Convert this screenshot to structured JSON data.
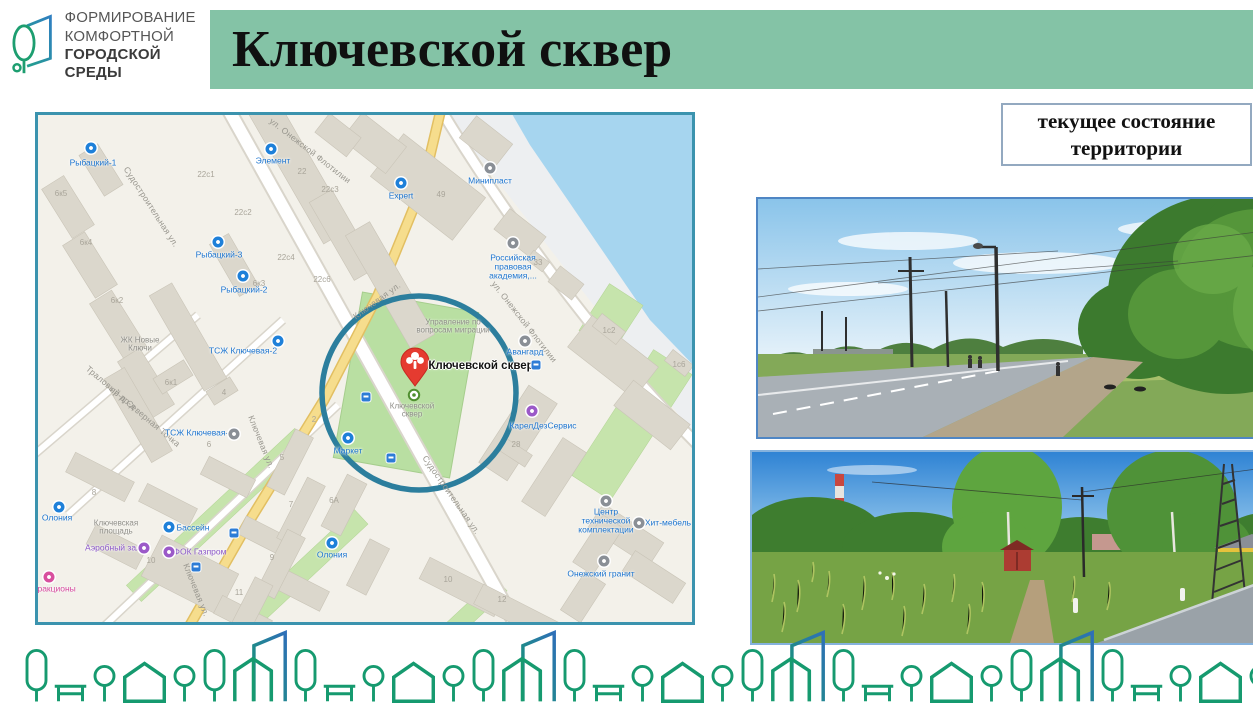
{
  "header": {
    "logo": {
      "lines": [
        "ФОРМИРОВАНИЕ",
        "КОМФОРТНОЙ",
        "ГОРОДСКОЙ СРЕДЫ"
      ]
    },
    "title": "Ключевской сквер",
    "banner_color": "#84c3a6"
  },
  "status_box": {
    "text": "текущее состояние территории",
    "border_color": "#93a9c0"
  },
  "map": {
    "border_color": "#3b93ae",
    "highlight": {
      "shape": "circle",
      "color": "#2c7e9d"
    },
    "pin": {
      "label": "Ключевской сквер",
      "color": "#e53b30"
    },
    "marker_caption": "Ключевской сквер",
    "labels": [
      {
        "t": "Судостроительная ул.",
        "x": 113,
        "y": 92,
        "cls": "street",
        "r": 57
      },
      {
        "t": "ул. Онежской Флотилии",
        "x": 272,
        "y": 36,
        "cls": "street",
        "r": 38
      },
      {
        "t": "ул. Онежской Флотилии",
        "x": 486,
        "y": 207,
        "cls": "street",
        "r": 52
      },
      {
        "t": "Ключевая ул.",
        "x": 339,
        "y": 186,
        "cls": "street",
        "r": -36
      },
      {
        "t": "Ключевая ул.",
        "x": 223,
        "y": 327,
        "cls": "street",
        "r": 68
      },
      {
        "t": "Ключевая ул.",
        "x": 158,
        "y": 475,
        "cls": "street",
        "r": 68
      },
      {
        "t": "Судостроительная ул.",
        "x": 413,
        "y": 380,
        "cls": "street",
        "r": 55
      },
      {
        "t": "Траловый пр-д",
        "x": 73,
        "y": 273,
        "cls": "street",
        "r": 40
      },
      {
        "t": "пр-д Северная Точка",
        "x": 107,
        "y": 302,
        "cls": "street",
        "r": 40
      },
      {
        "t": "Рыбацкий-1",
        "x": 55,
        "y": 48,
        "cls": "poi"
      },
      {
        "t": "Элемент",
        "x": 235,
        "y": 46,
        "cls": "poi"
      },
      {
        "t": "Expert",
        "x": 363,
        "y": 81,
        "cls": "poi"
      },
      {
        "t": "Рыбацкий-3",
        "x": 181,
        "y": 140,
        "cls": "poi"
      },
      {
        "t": "Рыбацкий-2",
        "x": 206,
        "y": 175,
        "cls": "poi"
      },
      {
        "t": "Минипласт",
        "x": 452,
        "y": 66,
        "cls": "poi"
      },
      {
        "t": "Российская правовая академия,...",
        "x": 475,
        "y": 152,
        "cls": "poi",
        "w": 64
      },
      {
        "t": "Авангард",
        "x": 487,
        "y": 237,
        "cls": "poi"
      },
      {
        "t": "Управление по вопросам миграции",
        "x": 415,
        "y": 212,
        "cls": "gray",
        "w": 80
      },
      {
        "t": "КарелДезСервис",
        "x": 505,
        "y": 311,
        "cls": "poi"
      },
      {
        "t": "Маркет",
        "x": 310,
        "y": 336,
        "cls": "poi"
      },
      {
        "t": "ТСЖ Ключевая-2",
        "x": 205,
        "y": 236,
        "cls": "poi"
      },
      {
        "t": "ТСЖ Ключевая-6",
        "x": 161,
        "y": 318,
        "cls": "poi"
      },
      {
        "t": "ЖК Новые Ключи",
        "x": 102,
        "y": 230,
        "cls": "gray",
        "w": 56
      },
      {
        "t": "Ключевская площадь",
        "x": 78,
        "y": 413,
        "cls": "gray",
        "w": 70
      },
      {
        "t": "Бассейн",
        "x": 155,
        "y": 413,
        "cls": "poi"
      },
      {
        "t": "Аэробный зал",
        "x": 75,
        "y": 433,
        "cls": "purple"
      },
      {
        "t": "ФОК Газпром",
        "x": 162,
        "y": 437,
        "cls": "purple"
      },
      {
        "t": "Олония",
        "x": 19,
        "y": 403,
        "cls": "poi"
      },
      {
        "t": "Олония",
        "x": 294,
        "y": 440,
        "cls": "poi"
      },
      {
        "t": "Аттракционы",
        "x": 12,
        "y": 474,
        "cls": "pink"
      },
      {
        "t": "Центр технической комплектации",
        "x": 568,
        "y": 406,
        "cls": "poi",
        "w": 72
      },
      {
        "t": "Хит-мебель",
        "x": 630,
        "y": 408,
        "cls": "poi"
      },
      {
        "t": "Онежский гранит",
        "x": 563,
        "y": 459,
        "cls": "poi"
      },
      {
        "t": "Ключевской сквер",
        "x": 443,
        "y": 251,
        "cls": "title"
      },
      {
        "t": "Ключевской сквер",
        "x": 374,
        "y": 296,
        "cls": "gray",
        "w": 48
      },
      {
        "t": "6к5",
        "x": 23,
        "y": 79,
        "cls": "num"
      },
      {
        "t": "6к4",
        "x": 48,
        "y": 128,
        "cls": "num"
      },
      {
        "t": "6к2",
        "x": 79,
        "y": 186,
        "cls": "num"
      },
      {
        "t": "6к3",
        "x": 221,
        "y": 169,
        "cls": "num"
      },
      {
        "t": "22с1",
        "x": 168,
        "y": 60,
        "cls": "num"
      },
      {
        "t": "22с2",
        "x": 205,
        "y": 98,
        "cls": "num"
      },
      {
        "t": "22",
        "x": 264,
        "y": 57,
        "cls": "num"
      },
      {
        "t": "22с3",
        "x": 292,
        "y": 75,
        "cls": "num"
      },
      {
        "t": "22с4",
        "x": 248,
        "y": 143,
        "cls": "num"
      },
      {
        "t": "22с6",
        "x": 284,
        "y": 165,
        "cls": "num"
      },
      {
        "t": "49",
        "x": 403,
        "y": 80,
        "cls": "num"
      },
      {
        "t": "33",
        "x": 500,
        "y": 148,
        "cls": "num"
      },
      {
        "t": "1с2",
        "x": 571,
        "y": 216,
        "cls": "num"
      },
      {
        "t": "1с6",
        "x": 641,
        "y": 250,
        "cls": "num"
      },
      {
        "t": "6к1",
        "x": 133,
        "y": 268,
        "cls": "num"
      },
      {
        "t": "4",
        "x": 186,
        "y": 278,
        "cls": "num"
      },
      {
        "t": "6",
        "x": 171,
        "y": 330,
        "cls": "num"
      },
      {
        "t": "2",
        "x": 276,
        "y": 305,
        "cls": "num"
      },
      {
        "t": "5",
        "x": 244,
        "y": 343,
        "cls": "num"
      },
      {
        "t": "7",
        "x": 253,
        "y": 390,
        "cls": "num"
      },
      {
        "t": "6А",
        "x": 296,
        "y": 386,
        "cls": "num"
      },
      {
        "t": "9",
        "x": 234,
        "y": 443,
        "cls": "num"
      },
      {
        "t": "11",
        "x": 201,
        "y": 478,
        "cls": "num"
      },
      {
        "t": "8",
        "x": 56,
        "y": 378,
        "cls": "num"
      },
      {
        "t": "10",
        "x": 113,
        "y": 446,
        "cls": "num"
      },
      {
        "t": "28",
        "x": 478,
        "y": 330,
        "cls": "num"
      },
      {
        "t": "10",
        "x": 410,
        "y": 465,
        "cls": "num"
      },
      {
        "t": "12",
        "x": 464,
        "y": 485,
        "cls": "num"
      }
    ],
    "icons": [
      {
        "x": 53,
        "y": 33,
        "c": "#1e80d9"
      },
      {
        "x": 233,
        "y": 34,
        "c": "#1e80d9"
      },
      {
        "x": 363,
        "y": 68,
        "c": "#1e80d9"
      },
      {
        "x": 180,
        "y": 127,
        "c": "#1e80d9"
      },
      {
        "x": 205,
        "y": 161,
        "c": "#1e80d9"
      },
      {
        "x": 452,
        "y": 53,
        "c": "#8a8f96"
      },
      {
        "x": 475,
        "y": 128,
        "c": "#8a8f96"
      },
      {
        "x": 487,
        "y": 226,
        "c": "#8a8f96"
      },
      {
        "x": 494,
        "y": 296,
        "c": "#9b59c8"
      },
      {
        "x": 310,
        "y": 323,
        "c": "#1e80d9"
      },
      {
        "x": 240,
        "y": 226,
        "c": "#1e80d9"
      },
      {
        "x": 196,
        "y": 319,
        "c": "#8a8f96"
      },
      {
        "x": 131,
        "y": 412,
        "c": "#1e80d9"
      },
      {
        "x": 106,
        "y": 433,
        "c": "#9b59c8"
      },
      {
        "x": 131,
        "y": 437,
        "c": "#9b59c8"
      },
      {
        "x": 21,
        "y": 392,
        "c": "#1e80d9"
      },
      {
        "x": 294,
        "y": 428,
        "c": "#1e80d9"
      },
      {
        "x": 11,
        "y": 462,
        "c": "#d84f9e"
      },
      {
        "x": 568,
        "y": 386,
        "c": "#8a8f96"
      },
      {
        "x": 601,
        "y": 408,
        "c": "#8a8f96"
      },
      {
        "x": 566,
        "y": 446,
        "c": "#8a8f96"
      }
    ],
    "transit_stops": [
      {
        "x": 328,
        "y": 282
      },
      {
        "x": 353,
        "y": 343
      },
      {
        "x": 498,
        "y": 250
      },
      {
        "x": 196,
        "y": 418
      },
      {
        "x": 158,
        "y": 452
      }
    ]
  },
  "photos": [
    {
      "alt": "улица с асфальтовой дорогой, опорами освещения и зелёными деревьями"
    },
    {
      "alt": "заросший травой участок с тропинкой, деревьями и опорой ЛЭП"
    }
  ],
  "footer": {
    "unit": [
      "tree-tall",
      "bench",
      "tree-round",
      "house",
      "tree-round",
      "tree-tall",
      "house-tower"
    ],
    "repeat": 6,
    "color": "#169a6f"
  }
}
